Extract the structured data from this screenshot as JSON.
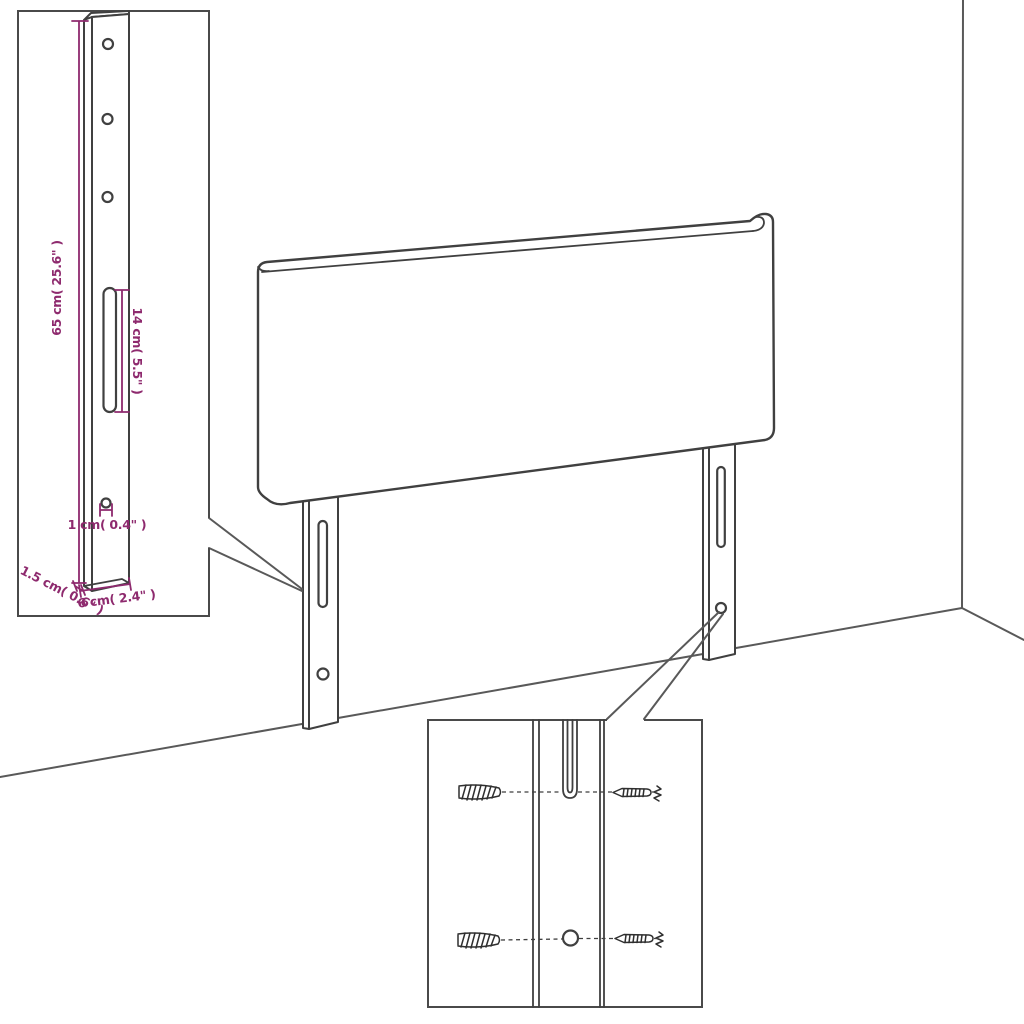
{
  "colors": {
    "background": "#ffffff",
    "line_color": "#404040",
    "wall_line_color": "#595959",
    "dimension_color": "#8e2a6e"
  },
  "dimensions": {
    "leg_height": "65 cm( 25.6\" )",
    "slot_length": "14 cm( 5.5\" )",
    "hole_diameter": "1 cm( 0.4\" )",
    "leg_thickness": "1.5 cm( 0.6\" )",
    "leg_width": "6 cm( 2.4\" )"
  }
}
